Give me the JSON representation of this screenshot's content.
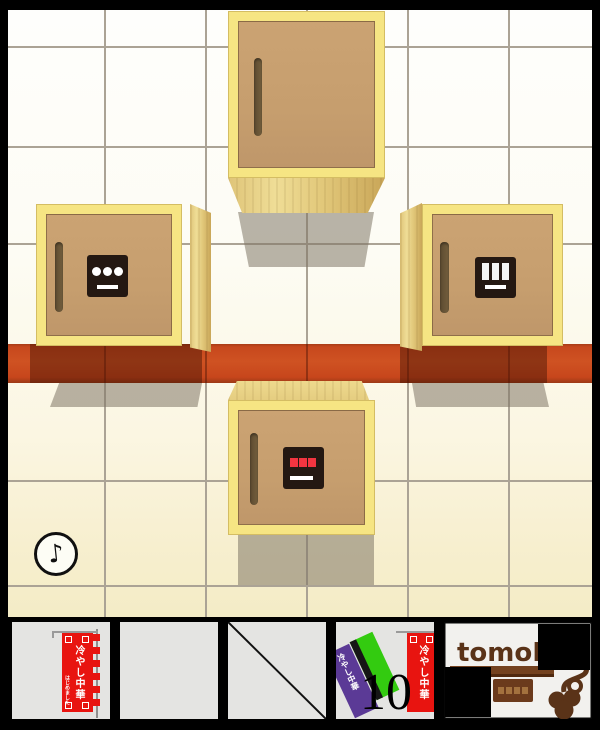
{
  "scene": {
    "sound_button": {
      "glyph": "♪"
    },
    "boxes": [
      {
        "name": "top-box",
        "icon": "none"
      },
      {
        "name": "left-box",
        "icon": "three-dots-with-underline"
      },
      {
        "name": "right-box",
        "icon": "three-bars-with-underline"
      },
      {
        "name": "bottom-box",
        "icon": "three-red-squares-with-underline"
      }
    ],
    "colors": {
      "stripe_red": "#c7481d",
      "tile": "#fdfbf2",
      "grout": "#aba395",
      "frame_yellow": "#f6e583",
      "box_face_tan": "#c69e6e",
      "icon_plate": "#241812",
      "icon_red_square": "#f23540"
    }
  },
  "inventory": {
    "slot1": {
      "item": "red-banner",
      "text": "冷やし中華",
      "subtext": "はじめました",
      "banner_color": "#e81410"
    },
    "slot2": {
      "item": "empty"
    },
    "slot3": {
      "item": "empty-crossed"
    },
    "slot4": {
      "item": "banner-bundle",
      "text": "冷やし中華",
      "count": "10",
      "colors": {
        "purple": "#5b3a96",
        "green": "#33cb10",
        "red": "#e81410"
      }
    },
    "slot5": {
      "item": "brand-logo",
      "brand": "tomoLa",
      "logo_color": "#5a3318"
    }
  }
}
